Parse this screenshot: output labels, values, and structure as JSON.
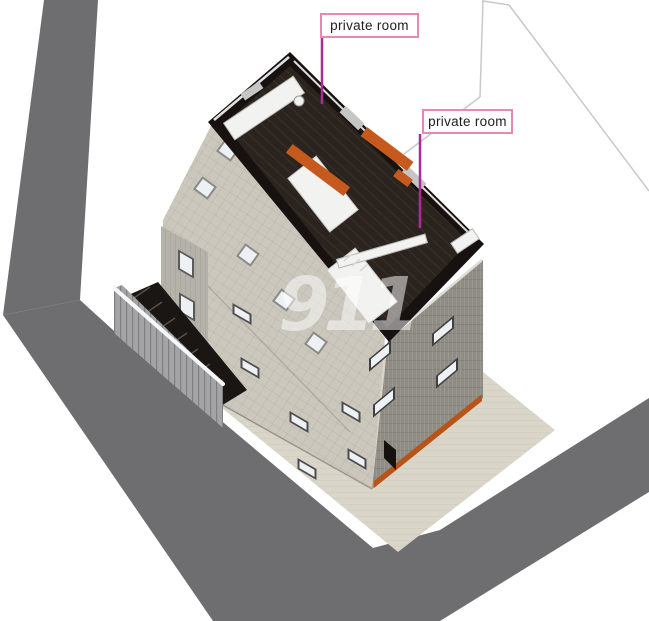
{
  "annotations": {
    "label1": "private room",
    "label2": "private room"
  },
  "watermark": {
    "text": "911"
  },
  "colors": {
    "background": "#ffffff",
    "road": "#6e6e70",
    "pavement": "#d9d5c8",
    "roof_tiles": "#cbc7bd",
    "right_facade": "#8f8c84",
    "nw_wall": "#b5b2aa",
    "fence": "#a4a4a6",
    "fence_rail": "#f7f7f7",
    "stairs_dark": "#191613",
    "wall_black": "#17120f",
    "interior_floor": "#2b241e",
    "furniture_white": "#f2f2f0",
    "accent_orange": "#c65a1e",
    "orange_base": "#b85418",
    "window_glass": "#eef1f4",
    "boundary_line": "#c9c9c9",
    "leader": "#ad2b96",
    "label_border": "#e886b8"
  }
}
